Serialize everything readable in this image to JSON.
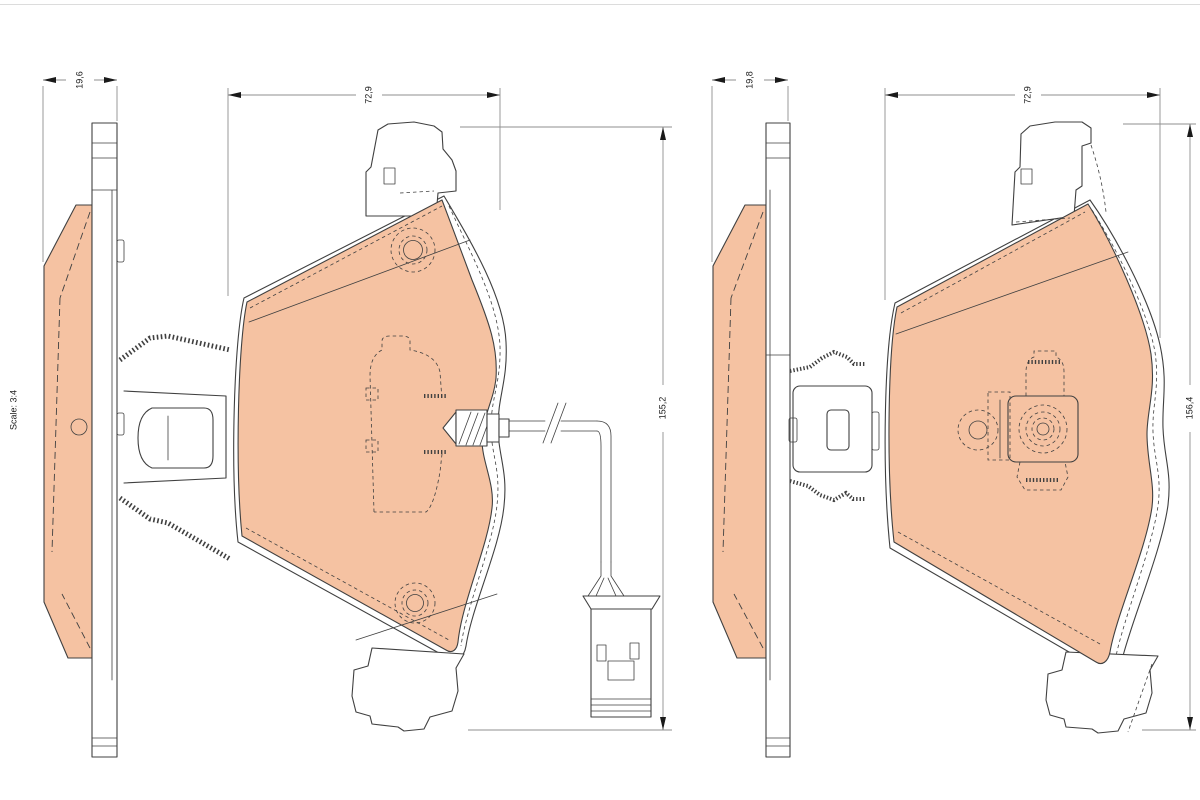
{
  "drawing": {
    "scale_label": "Scale: 3:4",
    "pads": [
      {
        "id": "left",
        "thickness": "19,6",
        "width": "72,9",
        "height": "155,2"
      },
      {
        "id": "right",
        "thickness": "19,8",
        "width": "72,9",
        "height": "156,4"
      }
    ],
    "colors": {
      "pad_fill": "#f5c2a2",
      "outline": "#404040",
      "dimension": "#8f8f8f",
      "text": "#1a1a1a",
      "background": "#ffffff"
    }
  }
}
